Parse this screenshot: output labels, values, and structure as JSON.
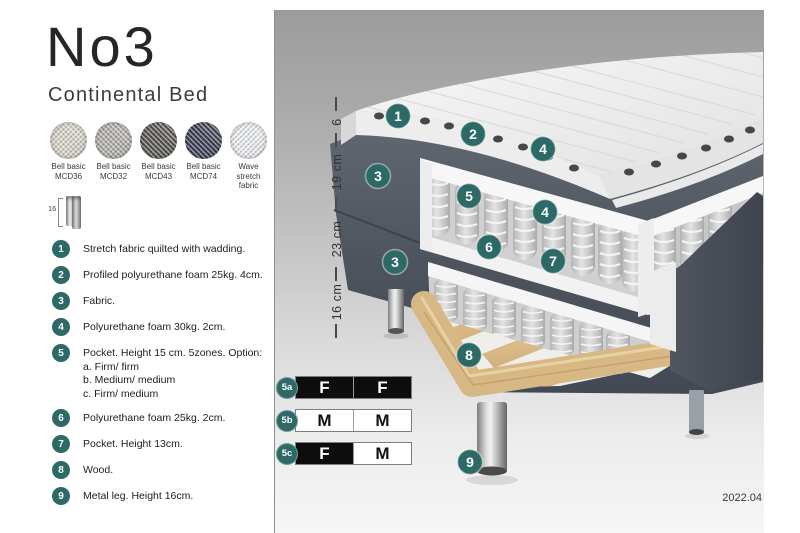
{
  "header": {
    "title": "No3",
    "subtitle": "Continental Bed"
  },
  "swatches": [
    {
      "line1": "Bell basic",
      "line2": "MCD36",
      "color": "#d8d4c9"
    },
    {
      "line1": "Bell basic",
      "line2": "MCD32",
      "color": "#b2b0ab"
    },
    {
      "line1": "Bell basic",
      "line2": "MCD43",
      "color": "#585652"
    },
    {
      "line1": "Bell basic",
      "line2": "MCD74",
      "color": "#3c4054"
    },
    {
      "line1": "Wave",
      "line2": "stretch fabric",
      "color": "#edeff2"
    }
  ],
  "leg_thumb": {
    "height_label": "16"
  },
  "legend": {
    "items": [
      {
        "num": "1",
        "text": "Stretch fabric quilted with wadding."
      },
      {
        "num": "2",
        "text": "Profiled polyurethane foam 25kg. 4cm."
      },
      {
        "num": "3",
        "text": "Fabric."
      },
      {
        "num": "4",
        "text": "Polyurethane foam 30kg. 2cm."
      },
      {
        "num": "5",
        "text": "Pocket. Height 15 cm. 5zones. Option:",
        "options": [
          "a. Firm/ firm",
          "b. Medium/ medium",
          "c. Firm/ medium"
        ]
      },
      {
        "num": "6",
        "text": "Polyurethane foam 25kg. 2cm."
      },
      {
        "num": "7",
        "text": "Pocket. Height 13cm."
      },
      {
        "num": "8",
        "text": "Wood."
      },
      {
        "num": "9",
        "text": "Metal leg. Height 16cm."
      }
    ]
  },
  "diagram": {
    "dimensions": [
      "6",
      "19 cm",
      "23 cm",
      "16 cm"
    ],
    "callouts": [
      "1",
      "2",
      "4",
      "3",
      "5",
      "4",
      "6",
      "3",
      "7",
      "8",
      "9"
    ],
    "colors": {
      "accent_teal": "#2d6a66",
      "fabric_dark": "#4e545e",
      "wood": "#dcbc8c",
      "spring": "#c9c9c9",
      "foam_white": "#f5f5f5"
    }
  },
  "spec_tables": [
    {
      "id": "5a",
      "cells": [
        {
          "value": "F",
          "variant": "dark"
        },
        {
          "value": "F",
          "variant": "dark"
        }
      ]
    },
    {
      "id": "5b",
      "cells": [
        {
          "value": "M",
          "variant": "light"
        },
        {
          "value": "M",
          "variant": "light"
        }
      ]
    },
    {
      "id": "5c",
      "cells": [
        {
          "value": "F",
          "variant": "dark"
        },
        {
          "value": "M",
          "variant": "light"
        }
      ]
    }
  ],
  "footer": {
    "version": "2022.04"
  }
}
